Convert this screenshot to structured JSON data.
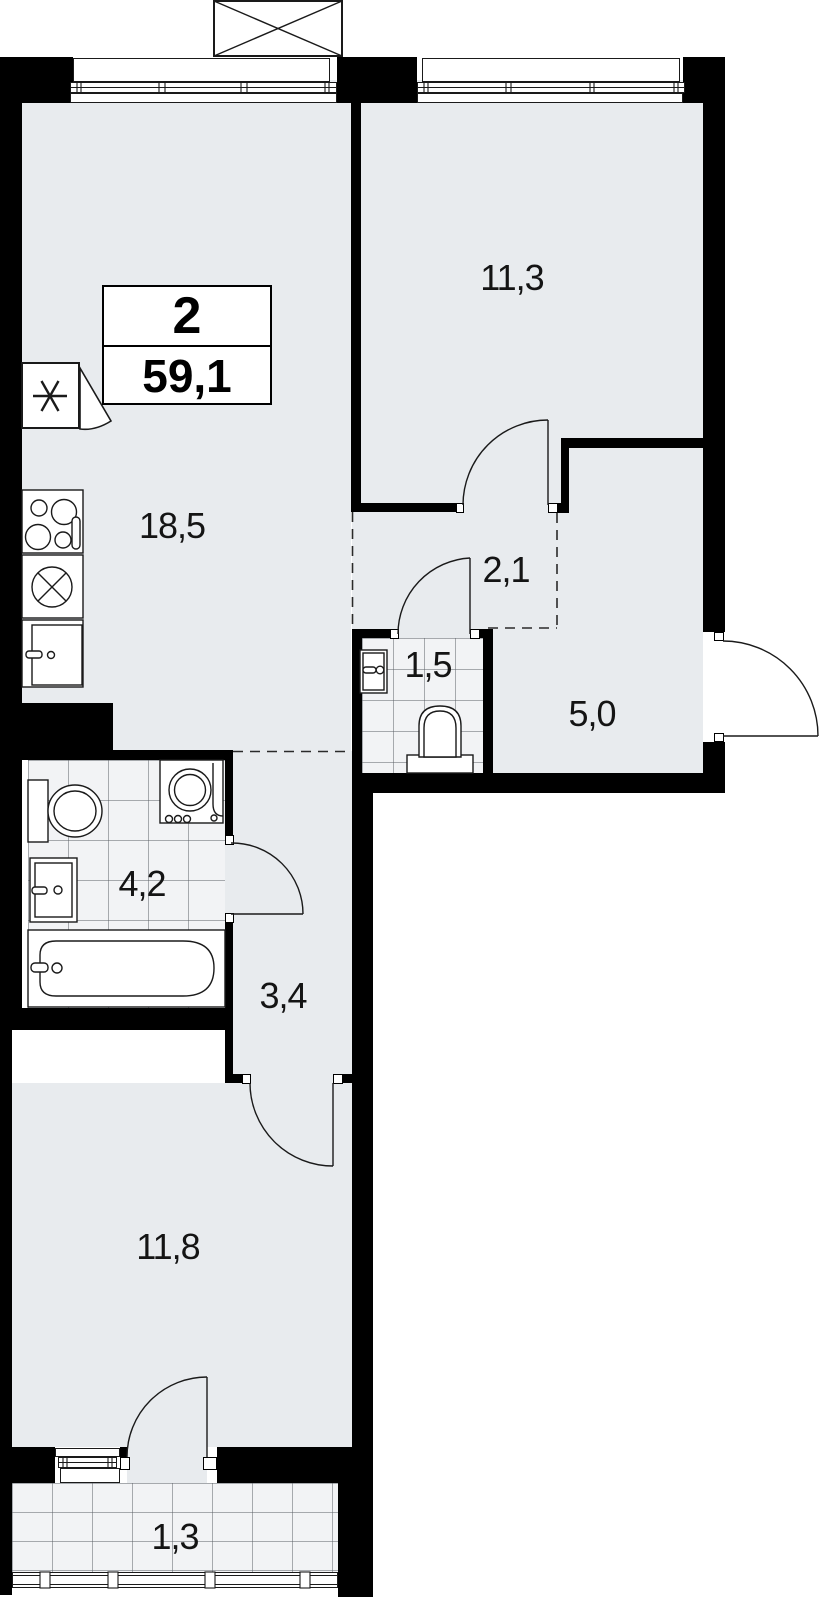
{
  "plan": {
    "type": "apartment-floor-plan",
    "summary": {
      "rooms_count": "2",
      "total_area": "59,1"
    },
    "rooms": [
      {
        "key": "kitchen-living",
        "area": "18,5"
      },
      {
        "key": "bedroom",
        "area": "11,3"
      },
      {
        "key": "wardrobe",
        "area": "2,1"
      },
      {
        "key": "wc",
        "area": "1,5"
      },
      {
        "key": "hallway",
        "area": "5,0"
      },
      {
        "key": "bathroom",
        "area": "4,2"
      },
      {
        "key": "corridor",
        "area": "3,4"
      },
      {
        "key": "bedroom-2",
        "area": "11,8"
      },
      {
        "key": "balcony",
        "area": "1,3"
      }
    ],
    "fixtures": [
      "ventilation-shaft",
      "vent-duct",
      "stove",
      "kitchen-sink",
      "kitchen-cabinet",
      "washing-machine",
      "toilet",
      "wash-basin",
      "bathtub",
      "wc-toilet",
      "wc-basin"
    ],
    "colors": {
      "wall": "#000000",
      "floor": "#e8ebee",
      "tile": "#f2f3f5",
      "line": "#1a1a1a"
    }
  }
}
